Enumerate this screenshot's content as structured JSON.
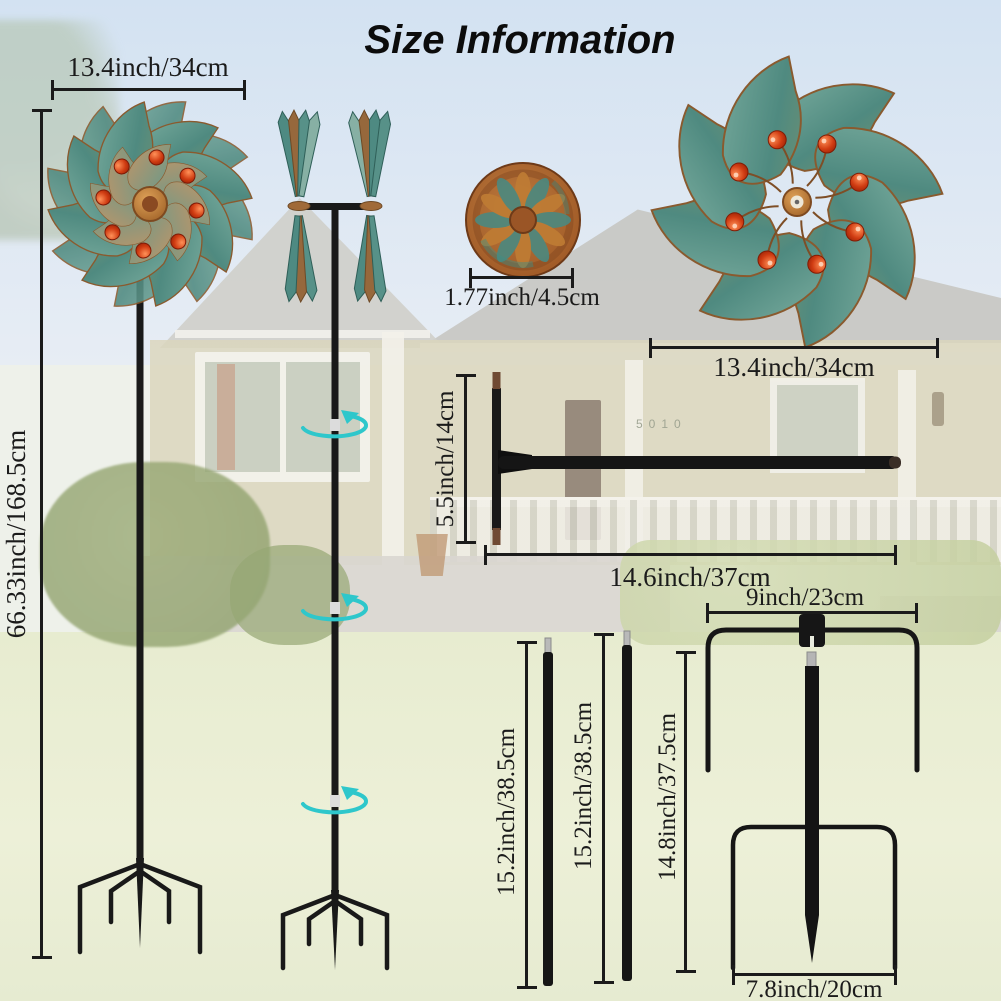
{
  "title": "Size Information",
  "house_number": "5010",
  "measurements": {
    "spinner_width_left": "13.4inch/34cm",
    "total_height": "66.33inch/168.5cm",
    "medallion_diameter": "1.77inch/4.5cm",
    "spinner_width_right": "13.4inch/34cm",
    "connector_height": "5.5inch/14cm",
    "connector_length": "14.6inch/37cm",
    "stake_top_width": "9inch/23cm",
    "pole_a_length": "15.2inch/38.5cm",
    "pole_b_length": "15.2inch/38.5cm",
    "stake_height": "14.8inch/37.5cm",
    "stake_bottom_width": "7.8inch/20cm"
  },
  "colors": {
    "ink": "#1b1b1b",
    "teal": "#56938a",
    "copper": "#a2693a",
    "bead": "#c83812",
    "metal": "#191919",
    "arrow": "#2ec7cb",
    "sky": "#d5e4f3",
    "lawn": "#eaeed3"
  }
}
